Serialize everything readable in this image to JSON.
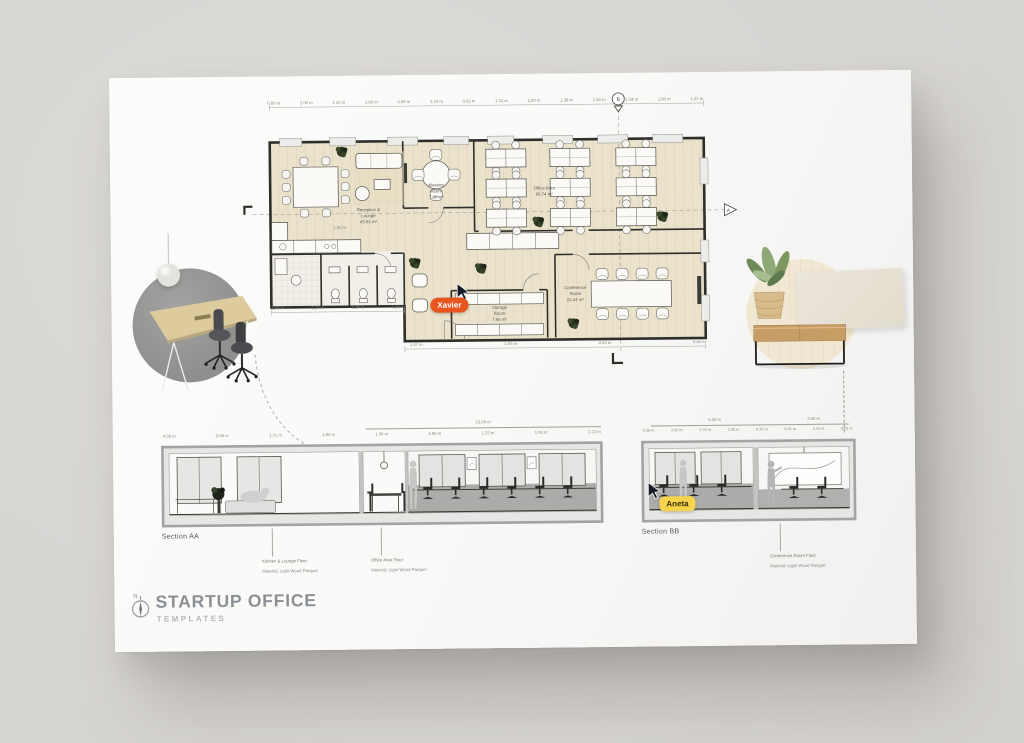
{
  "poster": {
    "title": "STARTUP OFFICE",
    "subtitle": "TEMPLATES",
    "north_label": "N"
  },
  "cursors": {
    "xavier": {
      "name": "Xavier",
      "color": "#E8541E",
      "text_color": "#FFFFFF"
    },
    "aneta": {
      "name": "Aneta",
      "color": "#F6D44D",
      "text_color": "#3A2E00"
    }
  },
  "plan": {
    "floor_color": "#EAE2CB",
    "rooms": {
      "reception": {
        "name": "Reception &",
        "name2": "Lounge",
        "area": "45.83 m²"
      },
      "meeting": {
        "name": "Meeting",
        "name2": "Room",
        "area": "7.80 m²"
      },
      "office": {
        "name": "Office Area",
        "area": "66.74 m²"
      },
      "storage": {
        "name": "Storage",
        "name2": "Room",
        "area": "7.66 m²"
      },
      "conference": {
        "name": "Conference",
        "name2": "Room",
        "area": "22.24 m²"
      }
    },
    "dims_top": [
      "0.60 m",
      "2.00 m",
      "1.10 m",
      "1.80 m",
      "0.90 m",
      "2.20 m",
      "0.62 m",
      "1.31 m",
      "1.80 m",
      "1.38 m",
      "1.80 m",
      "1.34 m",
      "1.80 m",
      "1.23 m"
    ],
    "dims_bottom": [
      "1.47 m",
      "1.00 m",
      "4.53 m",
      "5.41 m"
    ],
    "dims_left": [
      "1.98 m",
      "1.27 m",
      "1.29 m",
      "1.29 m"
    ],
    "dims_inner": [
      "1.80 m"
    ],
    "markers": {
      "section_a": "A",
      "section_b": "B"
    }
  },
  "sections": {
    "aa": {
      "caption": "Section AA",
      "dim_total": "10.66 m",
      "dims": [
        "4.38 m",
        "2.66 m",
        "1.31 m",
        "1.80 m",
        "1.36 m",
        "1.80 m",
        "1.33 m",
        "1.80 m",
        "1.23 m"
      ],
      "notes": [
        {
          "title": "Kitchen & Lounge Floor",
          "material": "Material:  Light Wood Parquet"
        },
        {
          "title": "Office Area Floor",
          "material": "Material: Light Wood Parquet"
        }
      ]
    },
    "bb": {
      "caption": "Section BB",
      "dim_totals": [
        "5.42 m",
        "3.43 m"
      ],
      "dims": [
        "0.36 m",
        "2.00 m",
        "0.70 m",
        "2.00 m",
        "0.35 m",
        "0.01 m",
        "2.41 m",
        "0.01 m"
      ],
      "notes": [
        {
          "title": "Conference Room Floor",
          "material": "Material: Light Wood Parquet"
        }
      ]
    }
  }
}
